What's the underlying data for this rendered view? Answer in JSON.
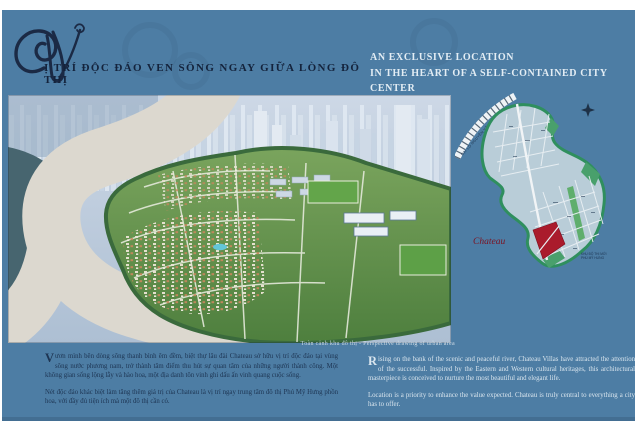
{
  "colors": {
    "panel": "#4d7da4",
    "text_dark": "#16263e",
    "text_light": "#dce8f1",
    "map_land": "#b9cdd8",
    "map_green": "#2f8f5e",
    "site_red": "#aa1b2c",
    "river": "#dcd8cf"
  },
  "header": {
    "decor_initial": "V",
    "title_vi": "Ị TRÍ ĐỘC ĐÁO VEN SÔNG NGAY GIỮA LÒNG ĐÔ THỊ",
    "title_en": [
      "AN EXCLUSIVE LOCATION",
      "IN THE HEART OF A SELF-CONTAINED CITY CENTER"
    ]
  },
  "hero": {
    "caption": "Toàn cảnh khu đô thị - Perspective drawing of urban area"
  },
  "map": {
    "site_label": "Chateau",
    "highway_label": "ĐẠI LỘ NGUYỄN VĂN LINH",
    "note": [
      "KHU ĐÔ THỊ MỚI",
      "PHÚ MỸ HƯNG"
    ],
    "compass_icon": "compass-rose"
  },
  "copy": {
    "vi": {
      "p1_initial": "V",
      "p1": "ươn mình bên dòng sông thanh bình êm đềm, biệt thự lâu đài Chateau sở hữu vị trí độc đáo tại vùng sông nước phương nam, trở thành tâm điểm thu hút sự quan tâm của những người thành công. Một không gian sống lộng lẫy và hào hoa, một địa danh tôn vinh ghi dấu ấn vinh quang cuộc sống.",
      "p2": "Nét độc đáo khác biệt làm tăng thêm giá trị của Chateau là vị trí ngay trung tâm đô thị Phú Mỹ Hưng phồn hoa, với đầy đủ tiện ích mà một đô thị cần có."
    },
    "en": {
      "p1_initial": "R",
      "p1": "ising on the bank of the scenic and peaceful river, Chateau Villas have attracted the attention of the successful. Inspired by the Eastern and Western cultural heritages, this architectural masterpiece is conceived to nurture the most beautiful and elegant life.",
      "p2": "Location is a priority to enhance the value expected. Chateau is truly central to everything a city has to offer."
    }
  }
}
